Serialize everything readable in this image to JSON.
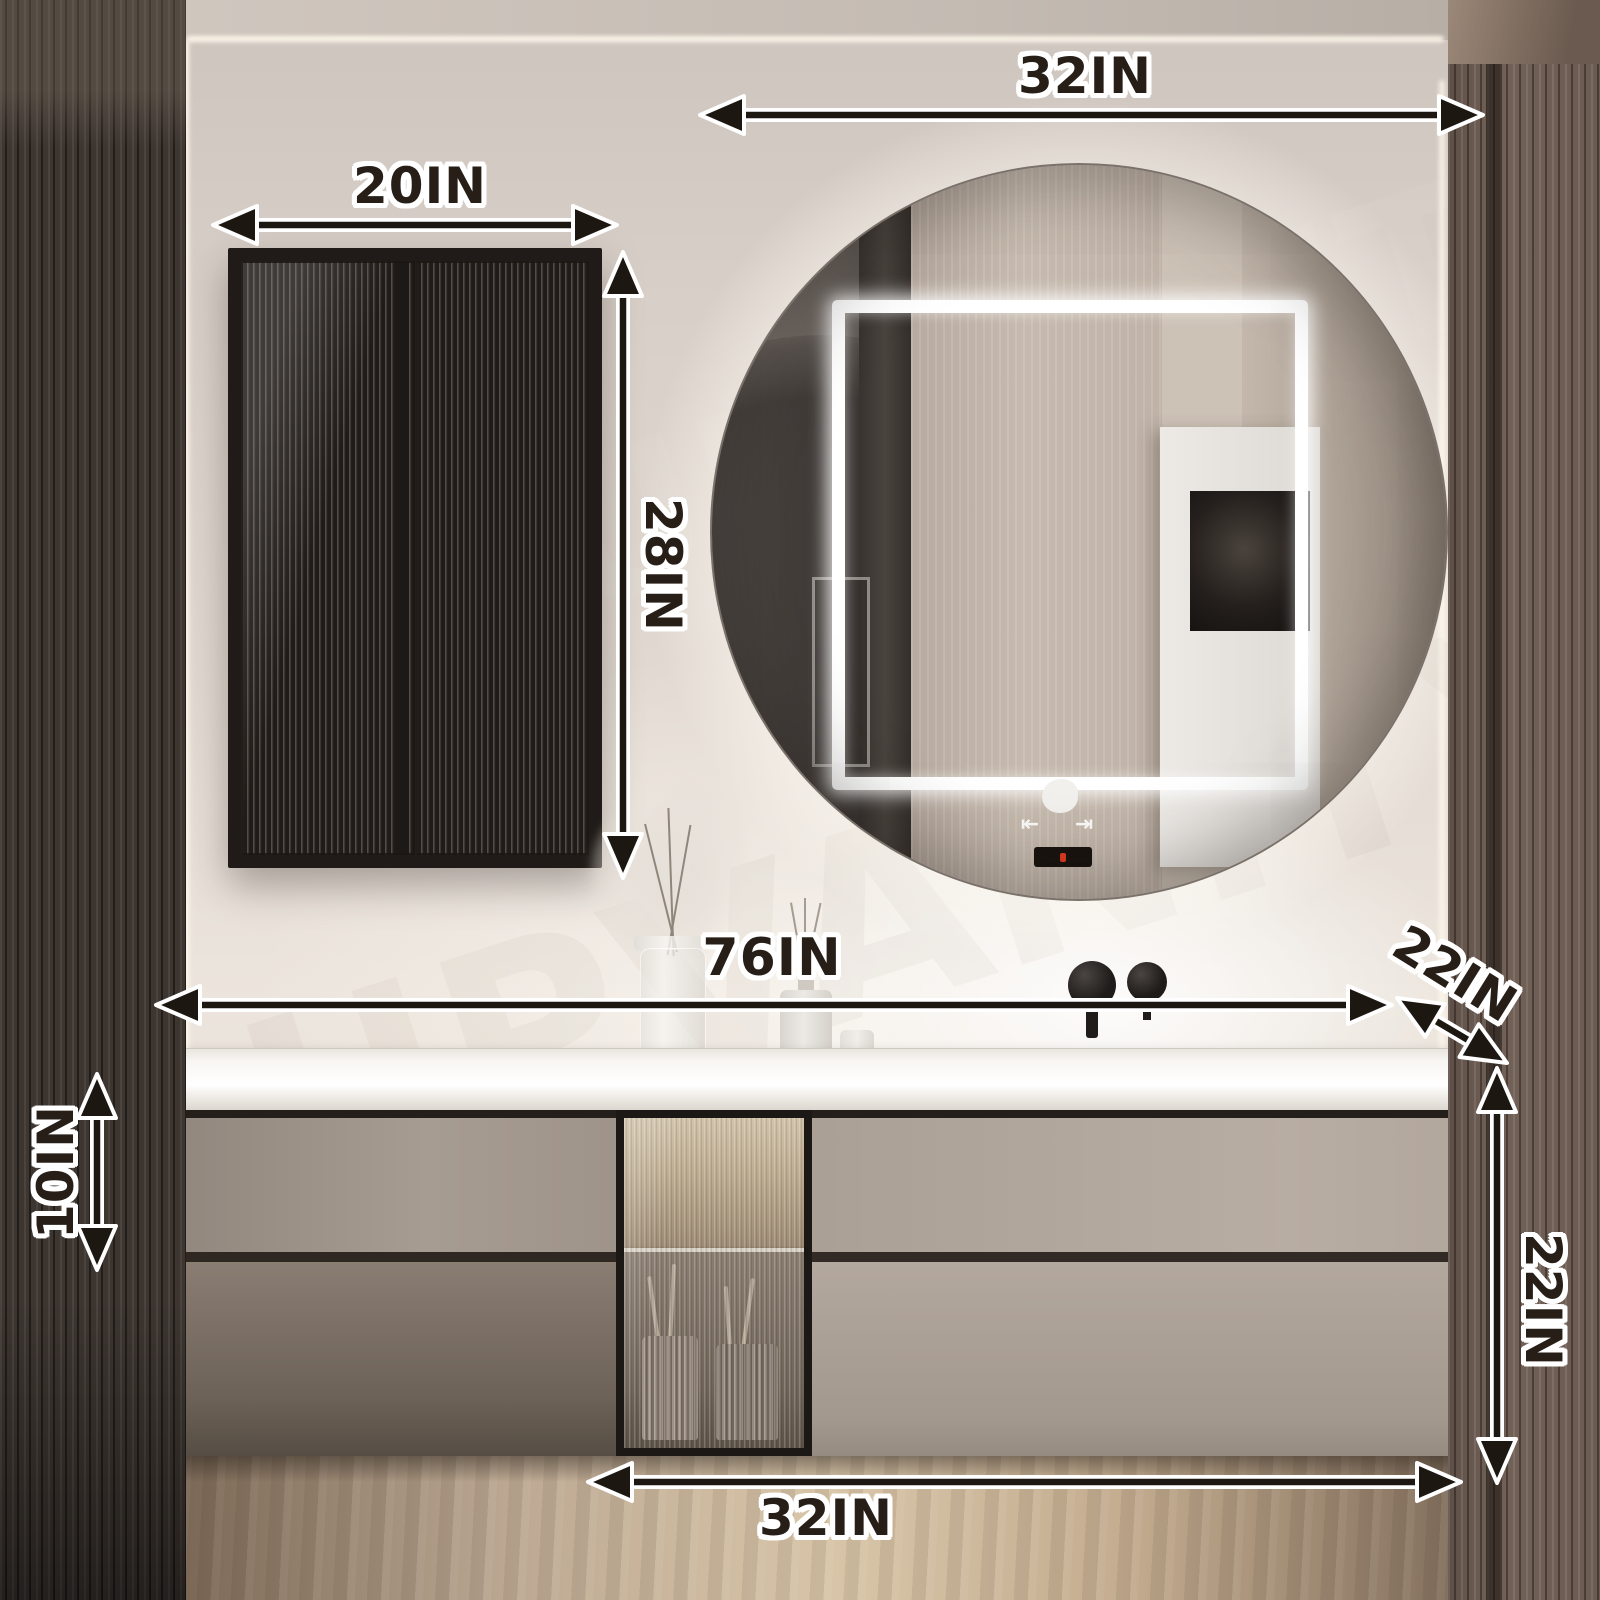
{
  "title": "Bathroom vanity set dimension diagram",
  "watermark": "UPVANITY",
  "dimensions": {
    "mirror_width": "32IN",
    "wall_cabinet_width": "20IN",
    "wall_cabinet_height": "28IN",
    "vanity_total_width": "76IN",
    "vanity_depth": "22IN",
    "countertop_drawer_height": "10IN",
    "vanity_total_height": "22IN",
    "vanity_right_section_width": "32IN"
  },
  "mirror_controls": {
    "left_glyph": "⇤",
    "right_glyph": "⇥",
    "display_indicator_color": "#e23a1e"
  },
  "colors": {
    "arrow": "#1d1712",
    "dimension_outline": "#ffffff",
    "dimension_text": "#261e17",
    "wall": "#d6cdc6",
    "warm_led": "#f0dcae",
    "countertop": "#f6f4f0"
  }
}
